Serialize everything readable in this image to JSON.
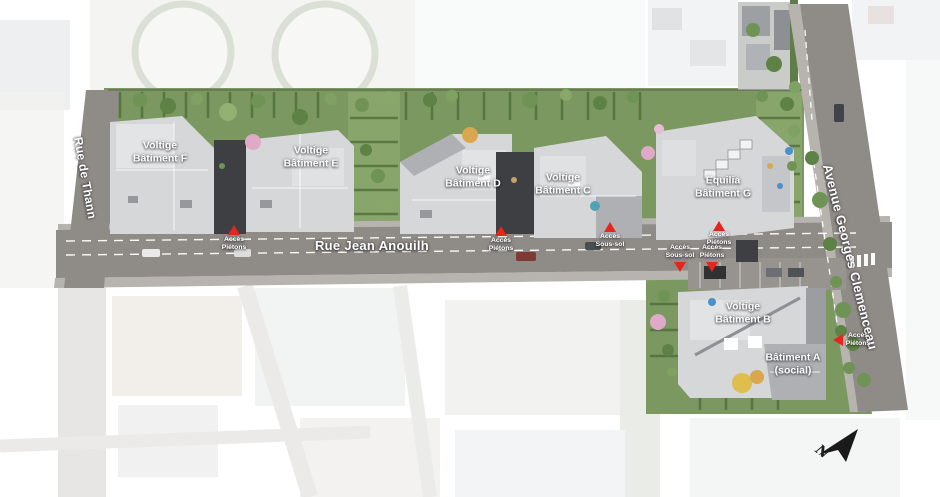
{
  "map": {
    "buildings": [
      {
        "id": "F",
        "line1": "Voltige",
        "line2": "Bâtiment F"
      },
      {
        "id": "E",
        "line1": "Voltige",
        "line2": "Bâtiment E"
      },
      {
        "id": "D",
        "line1": "Voltige",
        "line2": "Bâtiment D"
      },
      {
        "id": "C",
        "line1": "Voltige",
        "line2": "Bâtiment C"
      },
      {
        "id": "G",
        "line1": "Equilia",
        "line2": "Bâtiment G"
      },
      {
        "id": "B",
        "line1": "Voltige",
        "line2": "Bâtiment B"
      },
      {
        "id": "A",
        "line1": "Bâtiment A",
        "line2": "(social)"
      }
    ],
    "streets": {
      "left": "Rue de Thann",
      "main": "Rue Jean Anouilh",
      "right": "Avenue Georges Clemenceau"
    },
    "access_points": [
      {
        "line1": "Accès",
        "line2": "Piétons",
        "direction": "up"
      },
      {
        "line1": "Accès",
        "line2": "Piétons",
        "direction": "up"
      },
      {
        "line1": "Accès",
        "line2": "Sous-sol",
        "direction": "up"
      },
      {
        "line1": "Accès",
        "line2": "Piétons",
        "direction": "up"
      },
      {
        "line1": "Accès",
        "line2": "Sous-sol",
        "direction": "down"
      },
      {
        "line1": "Accès",
        "line2": "Piétons",
        "direction": "down"
      },
      {
        "line1": "Accès",
        "line2": "Piétons",
        "direction": "left"
      }
    ],
    "compass": {
      "letter": "N"
    },
    "colors": {
      "road": "#8f8b86",
      "sidewalk": "#b7b4af",
      "grass": "#7a985f",
      "grass_light": "#88a56c",
      "hedge": "#4e6e3a",
      "roof_light": "#d6d7d9",
      "roof_mid": "#aeb0b3",
      "roof_dark": "#3d3f42",
      "marker": "#e8251d"
    }
  }
}
